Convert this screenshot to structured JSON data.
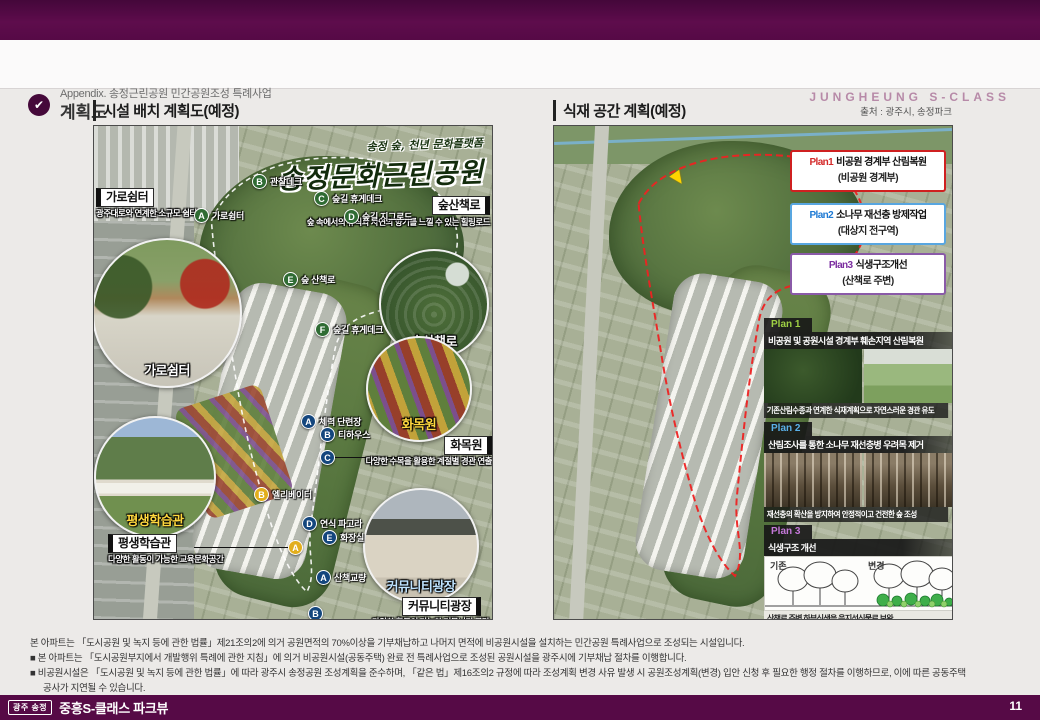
{
  "header": {
    "appendix_label": "Appendix. 송정근린공원 민간공원조성 특례사업",
    "page_title": "계획도",
    "brand": "JUNGHEUNG S-CLASS",
    "check_glyph": "✔"
  },
  "source_note": "출처 : 광주시, 송정파크",
  "left_panel": {
    "title": "시설 배치 계획도(예정)",
    "map_title_small": "송정 숲, 천년 문화플랫폼",
    "map_title_big": "송정문화근린공원",
    "labels": {
      "garo": {
        "title": "가로쉼터",
        "subtitle": "광주대로와 연계한 소규모 쉼터"
      },
      "sup": {
        "title": "숲산책로",
        "subtitle": "숲 속에서의 휴식과 자연의 향기를 느낄 수 있는 힐링로드"
      },
      "hwamok": {
        "title": "화목원",
        "subtitle": "다양한 수목을 활용한 계절별 경관 연출"
      },
      "pyeong": {
        "title": "평생학습관",
        "subtitle": "다양한 활동이 가능한 교육문화공간"
      },
      "community": {
        "title": "커뮤니티광장",
        "subtitle": "다양한 활동이 가능한 커뮤니티 공간"
      }
    },
    "captions": {
      "garo": "가로쉼터",
      "forest": "숲산책로",
      "hwamok": "화목원",
      "learn": "평생학습관",
      "community": "커뮤니티광장"
    },
    "green_markers": [
      {
        "letter": "A",
        "label": "가로쉼터"
      },
      {
        "letter": "B",
        "label": "관찰데크"
      },
      {
        "letter": "C",
        "label": "숲길 휴게데크"
      },
      {
        "letter": "D",
        "label": "숲길 지그로드"
      },
      {
        "letter": "E",
        "label": "숲 산책로"
      },
      {
        "letter": "F",
        "label": "숲길 휴게데크"
      }
    ],
    "blue_markers": [
      {
        "letter": "A",
        "label": "체력 단련장"
      },
      {
        "letter": "B",
        "label": "티하우스"
      },
      {
        "letter": "C",
        "label": ""
      },
      {
        "letter": "D",
        "label": "연식 파고라"
      },
      {
        "letter": "E",
        "label": "화장실"
      },
      {
        "letter": "A",
        "label": "산책교량"
      },
      {
        "letter": "B",
        "label": ""
      }
    ],
    "yellow_markers": [
      {
        "letter": "B",
        "label": "엘리베이터"
      },
      {
        "letter": "A",
        "label": ""
      }
    ]
  },
  "right_panel": {
    "title": "식재 공간 계획(예정)",
    "legend": [
      {
        "plan": "Plan1",
        "rest": "비공원 경계부 산림복원",
        "sub": "(비공원 경계부)"
      },
      {
        "plan": "Plan2",
        "rest": "소나무 재선충 방제작업",
        "sub": "(대상지 전구역)"
      },
      {
        "plan": "Plan3",
        "rest": "식생구조개선",
        "sub": "(산책로 주변)"
      }
    ],
    "cards": [
      {
        "tab": "Plan 1",
        "title": "비공원 및 공원시설 경계부 훼손지역 산림복원",
        "caption": "기존산림수종과 연계한 식재계획으로 자연스러운 경관 유도"
      },
      {
        "tab": "Plan 2",
        "title": "산림조사를 통한 소나무 재선충병 우려목 제거",
        "caption": "재선충의 확산을 방지하여 안정적이고 건전한 숲 조성"
      },
      {
        "tab": "Plan 3",
        "title": "식생구조 개선",
        "before_label": "기존",
        "after_label": "변경",
        "caption": "산책로 주변 하부식생을 음지성식물로 보완"
      }
    ]
  },
  "notes": {
    "line1": "본 아파트는 「도시공원 및 녹지 등에 관한 법률」제21조의2에 의거 공원면적의 70%이상을 기부채납하고 나머지 면적에 비공원시설을 설치하는 민간공원 특례사업으로 조성되는 시설입니다.",
    "line2": "■ 본 아파트는 「도시공원부지에서 개발행위 특례에 관한 지침」에 의거 비공원시설(공동주택) 완료 전 특례사업으로 조성된 공원시설을 광주시에 기부채납 절차를 이행합니다.",
    "line3": "■ 비공원시설은 「도시공원 및 녹지 등에 관한 법률」에 따라 광주시 송정공원 조성계획을 준수하며, 「같은 법」제16조의2 규정에 따라 조성계획 변경 사유 발생 시 공원조성계획(변경) 입안 신청 후 필요한 행정 절차를 이행하므로, 이에 따른 공동주택",
    "line4": "공사가 지연될 수 있습니다."
  },
  "footer": {
    "badge": "광주 송정",
    "brand": "중흥S-클래스 파크뷰",
    "page": "11"
  },
  "colors": {
    "brand_purple": "#560a46",
    "plan1_red": "#d42a2a",
    "plan2_blue": "#1e7ad4",
    "plan3_purple": "#7b2da0"
  }
}
